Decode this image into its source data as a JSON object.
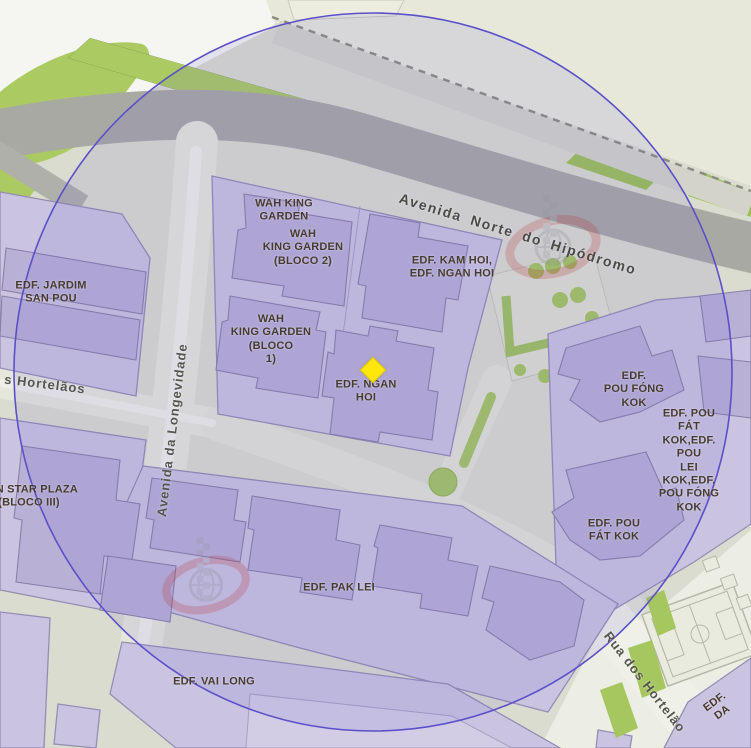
{
  "map": {
    "streets": {
      "avenida_norte_do_hipodromo": "Avenida Norte do Hipódromo",
      "avenida_da_longevidade": "Avenida da Longevidade",
      "rua_dos_hortelaos_left": "s Hortelãos",
      "rua_dos_hortelaos_right": "Rua dos Hortelão"
    },
    "buildings": {
      "wah_king_garden": "WAH KING\nGARDEN",
      "wah_king_garden_bloco_2": "WAH\nKING GARDEN\n(BLOCO 2)",
      "edf_kam_hoi_edf_ngan_hoi": "EDF. KAM HOI,\nEDF. NGAN HOI",
      "wah_king_garden_bloco_1": "WAH\nKING GARDEN\n(BLOCO\n1)",
      "edf_jardim_san_pou": "EDF. JARDIM\nSAN POU",
      "edf_ngan_hoi": "EDF. NGAN\nHOI",
      "sun_star_plaza_bloco_iii": "SUN STAR PLAZA\n(BLOCO III)",
      "edf_pou_fong_kok": "EDF.\nPOU FÓNG\nKOK",
      "edf_pou_fat_kok_group": "EDF. POU FÁT\nKOK,EDF. POU\nLEI KOK,EDF.\nPOU FÓNG KOK",
      "edf_pou_fat_kok": "EDF. POU\nFÁT KOK",
      "edf_pak_lei": "EDF. PAK LEI",
      "edf_vai_long": "EDF. VAI LONG",
      "edf_corner_partial": "EDF.\nDA"
    },
    "marker": {
      "shape": "diamond",
      "color": "#FFE70A"
    },
    "radius_circle": {
      "stroke_color": "#5B50C8",
      "fill_color": "rgba(102,92,206,0.12)"
    },
    "colors": {
      "building_block": "#CBC4E0",
      "building": "#B9B0D5",
      "main_road": "#A9A9A4",
      "park_green": "#ABCA62",
      "ground": "#DBDCD0"
    }
  }
}
